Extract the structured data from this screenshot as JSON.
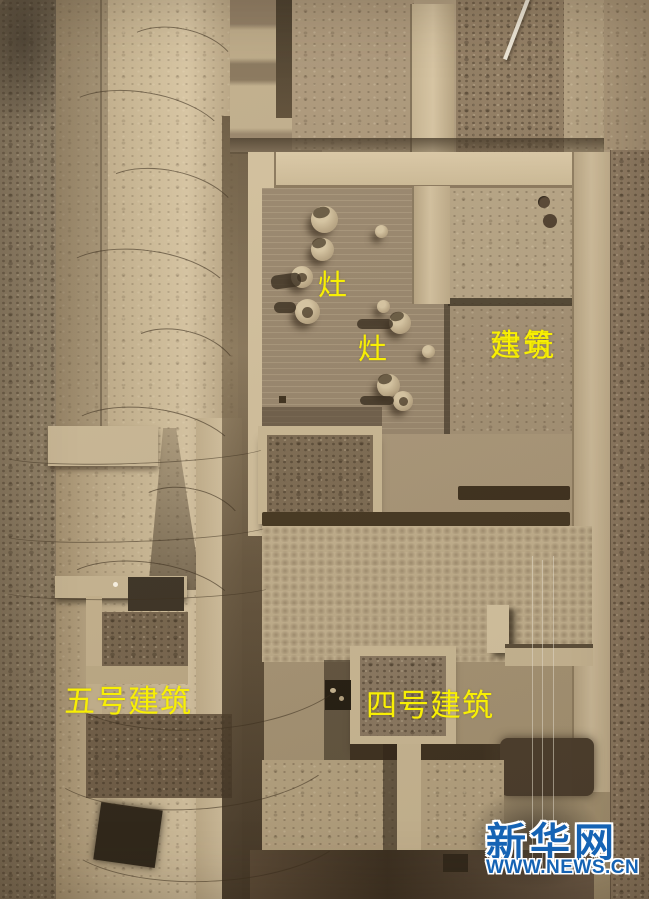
{
  "photo": {
    "annotation_color": "#f8ef04",
    "annotations": {
      "stove_upper": "灶",
      "stove_lower": "灶",
      "building6_line1": "六号",
      "building6_line2": "建筑",
      "building5": "五号建筑",
      "building4": "四号建筑"
    }
  },
  "watermark": {
    "brand": "新华网",
    "domain": "WWW.NEWS.CN",
    "color": "#1563b4"
  }
}
